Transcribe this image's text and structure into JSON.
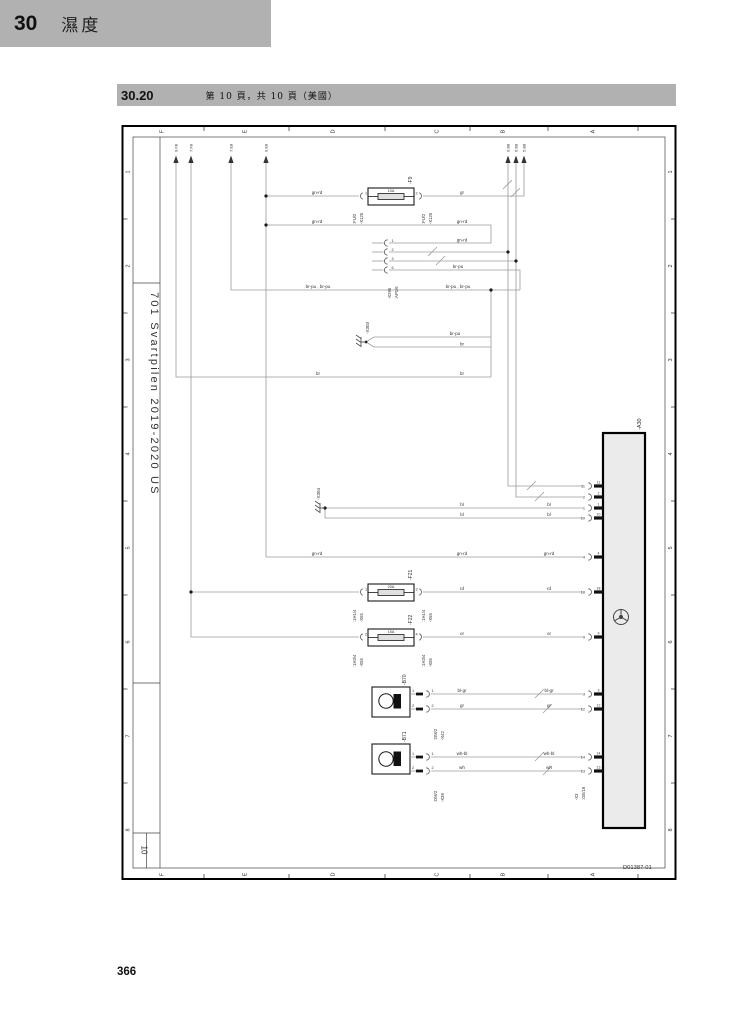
{
  "header": {
    "chapter_no": "30",
    "chapter_title": "濕度"
  },
  "section": {
    "code": "30.20",
    "page_info": "第 10 頁，共 10 頁（美國）"
  },
  "footer": {
    "page_number": "366"
  },
  "title_block": {
    "model": "701 Svartpilen 2019-2020 US",
    "sheet_number": "10",
    "drawing_number": "D01387-01"
  },
  "frame": {
    "cols": [
      "F",
      "E",
      "D",
      "C",
      "B",
      "A"
    ],
    "rows": [
      "1",
      "2",
      "3",
      "4",
      "5",
      "6",
      "7",
      "8"
    ]
  },
  "refs": {
    "top_left": [
      "9.F8",
      "7.F8",
      "7.E8",
      "9.E8"
    ],
    "top_right": [
      "9.B8",
      "6.B8",
      "5.B8"
    ]
  },
  "components": {
    "f9": {
      "name": "-F9",
      "rating": "10A",
      "pin_left": "1",
      "pin_right": "2",
      "conn_name": "-X125",
      "conn_pin": ":FU/2"
    },
    "f21": {
      "name": "-F21",
      "rating": "20A",
      "pin_left": "1",
      "pin_right": "3",
      "conn_name": "-X55",
      "conn_pin": ":1H1/4"
    },
    "f22": {
      "name": "-F22",
      "rating": "15A",
      "pin_left": "2",
      "pin_right": "4",
      "conn_name": "-X55",
      "conn_pin": ":1H3/4"
    },
    "x295": {
      "name": "-X295",
      "conn_pin": ":AP1/6",
      "pins": [
        "1",
        "2",
        "3",
        "6"
      ]
    },
    "x303": {
      "name": "-X303"
    },
    "x304": {
      "name": "-X304"
    },
    "a30": {
      "name": "-A30",
      "conn_name": "-X3",
      "conn_pin": ":GE/18",
      "pins": [
        "11",
        "2",
        "1",
        "10",
        "4",
        "18",
        "9",
        "3",
        "12",
        "14",
        "13"
      ]
    },
    "b70": {
      "name": "-B70",
      "conn_name": "-X42",
      "conn_pin": ":DM/2",
      "pins": [
        "1",
        "2"
      ]
    },
    "b71": {
      "name": "-B71",
      "conn_name": "-X39",
      "conn_pin": ":DM/2",
      "pins": [
        "1",
        "2"
      ]
    }
  },
  "wires": {
    "gn_rd": "gn-rd",
    "gr": "gr",
    "br_pu": "br-pu",
    "br_pu_pair": "br-pu , br-pu",
    "br": "br",
    "bl": "bl",
    "rd": "rd",
    "or": "or",
    "bl_gr": "bl-gr",
    "wh_bl": "wh-bl",
    "wh": "wh"
  }
}
